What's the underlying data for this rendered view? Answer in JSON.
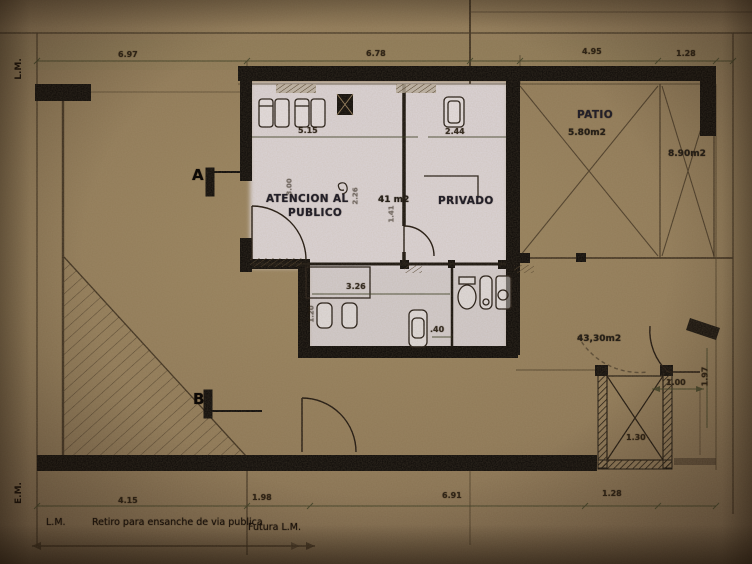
{
  "colors": {
    "paper_brown": "#8f7957",
    "room_highlight": "#ddd7dc",
    "wall_black": "#0b0806",
    "ink": "#1c140d"
  },
  "rooms": {
    "atencion": {
      "line1": "ATENCION AL",
      "line2": "PUBLICO",
      "area": "41 m2"
    },
    "privado": {
      "label": "PRIVADO"
    },
    "patio": {
      "label": "PATIO",
      "area": "5.80m2"
    },
    "side_room": {
      "area": "8.90m2"
    },
    "yard": {
      "area": "43,30m2"
    }
  },
  "markers": {
    "a": "A",
    "b": "B"
  },
  "boundary": {
    "lm_left": "L.M.",
    "em_left": "E.M.",
    "lm_bottom": "L.M.",
    "retiro": "Retiro para ensanche de via publica",
    "futura": "Futura L.M."
  },
  "dimensions": [
    {
      "text": "6.97",
      "x": 118,
      "y": 50
    },
    {
      "text": "6.78",
      "x": 366,
      "y": 49
    },
    {
      "text": "4.95",
      "x": 582,
      "y": 47
    },
    {
      "text": "1.28",
      "x": 676,
      "y": 49
    },
    {
      "text": "5.15",
      "x": 298,
      "y": 126
    },
    {
      "text": "2.44",
      "x": 445,
      "y": 127
    },
    {
      "text": "3.26",
      "x": 346,
      "y": 282
    },
    {
      "text": ".40",
      "x": 430,
      "y": 325
    },
    {
      "text": "1.20",
      "x": 303,
      "y": 310,
      "rot": true,
      "faint": true
    },
    {
      "text": "3.00",
      "x": 281,
      "y": 183,
      "rot": true,
      "faint": true
    },
    {
      "text": "2.26",
      "x": 347,
      "y": 192,
      "rot": true,
      "faint": true
    },
    {
      "text": "1.41",
      "x": 383,
      "y": 210,
      "rot": true,
      "faint": true
    },
    {
      "text": "1.00",
      "x": 666,
      "y": 378
    },
    {
      "text": "1.97",
      "x": 695,
      "y": 372,
      "rot": true
    },
    {
      "text": "1.30",
      "x": 626,
      "y": 433
    },
    {
      "text": "4.15",
      "x": 118,
      "y": 496
    },
    {
      "text": "1.98",
      "x": 252,
      "y": 493
    },
    {
      "text": "6.91",
      "x": 442,
      "y": 491
    },
    {
      "text": "1.28",
      "x": 602,
      "y": 489
    }
  ]
}
